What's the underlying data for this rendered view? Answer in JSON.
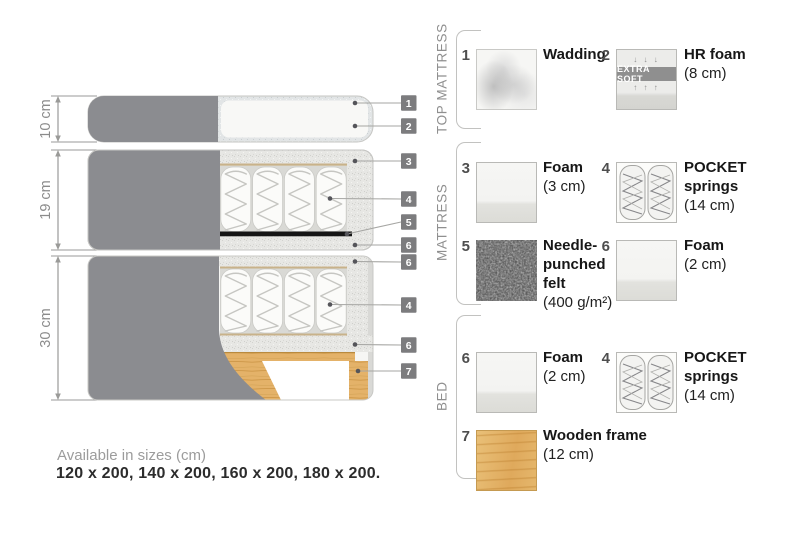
{
  "diagram": {
    "measurements": [
      {
        "label": "10 cm"
      },
      {
        "label": "19 cm"
      },
      {
        "label": "30 cm"
      }
    ],
    "tags": [
      {
        "num": "1"
      },
      {
        "num": "2"
      },
      {
        "num": "3"
      },
      {
        "num": "4"
      },
      {
        "num": "5"
      },
      {
        "num": "6"
      },
      {
        "num": "6"
      },
      {
        "num": "4"
      },
      {
        "num": "6"
      },
      {
        "num": "7"
      }
    ]
  },
  "legend": {
    "sections": [
      {
        "label": "TOP MATTRESS",
        "items": [
          {
            "num": "1",
            "name": "Wadding",
            "size": ""
          },
          {
            "num": "2",
            "name": "HR foam",
            "size": "(8 cm)",
            "band_label": "EXTRA SOFT",
            "arrows_down": "↓ ↓ ↓",
            "arrows_up": "↑ ↑ ↑"
          }
        ]
      },
      {
        "label": "MATTRESS",
        "items": [
          {
            "num": "3",
            "name": "Foam",
            "size": "(3 cm)"
          },
          {
            "num": "4",
            "name": "POCKET\nsprings",
            "size": "(14 cm)"
          },
          {
            "num": "5",
            "name": "Needle-\npunched\nfelt",
            "size": "(400 g/m²)"
          },
          {
            "num": "6",
            "name": "Foam",
            "size": "(2 cm)"
          }
        ]
      },
      {
        "label": "BED",
        "items": [
          {
            "num": "6",
            "name": "Foam",
            "size": "(2 cm)"
          },
          {
            "num": "4",
            "name": "POCKET\nsprings",
            "size": "(14 cm)"
          },
          {
            "num": "7",
            "name": "Wooden frame",
            "size": "(12 cm)"
          }
        ]
      }
    ]
  },
  "footer": {
    "line1": "Available in sizes (cm)",
    "line2": "120 x 200, 140 x 200, 160 x 200, 180 x 200."
  },
  "colors": {
    "fabric_gray": "#8b8c90",
    "wood": "#e0af62",
    "felt_dark": "#555555",
    "tag_bg": "#7c7c7e",
    "text_dark": "#171717",
    "text_gray": "#9b9b9b"
  }
}
